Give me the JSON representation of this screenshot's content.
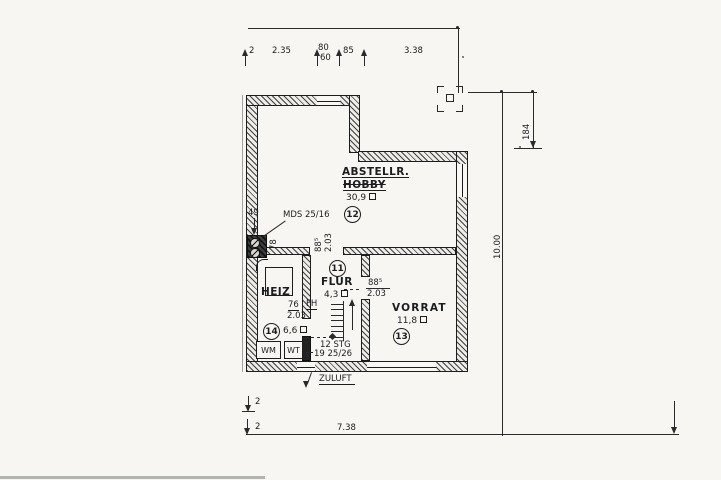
{
  "rooms": {
    "abstell": {
      "name": "ABSTELLR.",
      "struck_name": "HOBBY",
      "area": "30,9",
      "number": "12"
    },
    "flur": {
      "name": "FLUR",
      "area": "4,3",
      "number": "11"
    },
    "heiz": {
      "name": "HEIZ",
      "area": "6,6",
      "number": "14"
    },
    "vorrat": {
      "name": "VORRAT",
      "area": "11,8",
      "number": "13"
    }
  },
  "doors": {
    "abstell_flur": {
      "width": "88⁵",
      "height": "2.03"
    },
    "flur_vorrat": {
      "width": "88⁵",
      "height": "2.03"
    },
    "heiz": {
      "width": "76",
      "height": "2.03",
      "type": "FH"
    }
  },
  "stairs": {
    "steps": "12 STG",
    "dims": "19 25/26"
  },
  "fixtures": {
    "washing_machine": "WM",
    "wash_tub": "WT",
    "mds": "MDS 25/16",
    "zuluft": "ZULUFT"
  },
  "dimensions": {
    "top": {
      "edge": "2",
      "left": "2.35",
      "window_width": "80",
      "window_sill": "60",
      "mid": "85",
      "right": "3.38"
    },
    "left": {
      "niche_width": "49",
      "niche_height": "78"
    },
    "right": {
      "upper": "184",
      "total": "10.00"
    },
    "bottom": {
      "total": "7.38",
      "tick1": "2",
      "tick2": "2"
    }
  },
  "colors": {
    "line": "#2a2a2a",
    "paper": "#f7f6f3"
  }
}
